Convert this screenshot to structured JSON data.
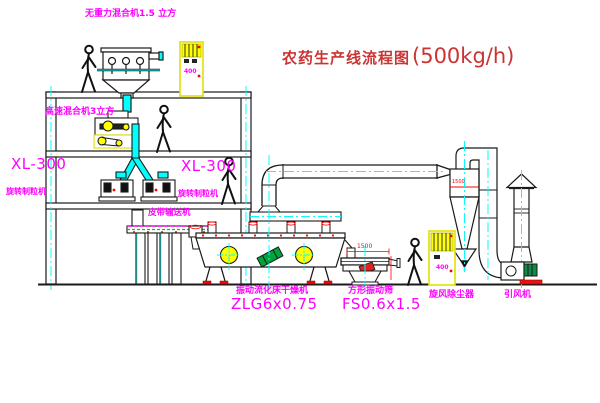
{
  "title": {
    "text": "农药生产线流程图",
    "capacity": "(500kg/h)"
  },
  "equipment": {
    "gravity_mixer": {
      "label": "无重力混合机1.5 立方"
    },
    "speed_mixer": {
      "label": "高速混合机3立方"
    },
    "granulator_left": {
      "model": "XL-300",
      "name": "旋转制粒机"
    },
    "granulator_mid": {
      "model": "XL-300",
      "name": "旋转制粒机"
    },
    "belt_conveyor": {
      "name": "皮带输送机"
    },
    "dryer": {
      "name": "振动流化床干燥机",
      "model": "ZLG6x0.75"
    },
    "screen": {
      "name": "方形振动筛",
      "model": "FS0.6x1.5"
    },
    "cyclone": {
      "name": "旋风除尘器",
      "dim": "1500"
    },
    "fan": {
      "name": "引风机"
    },
    "cabinet_top": {
      "text": "400"
    },
    "cabinet_right": {
      "text": "400"
    }
  },
  "dimensions": {
    "screen_width": "1500"
  },
  "colors": {
    "label_magenta": "#ff00ff",
    "title_red": "#cc3333",
    "cad_red": "#ff0000",
    "centerline_cyan": "#00ffff",
    "cabinet_yellow": "#ffff00",
    "motor_green": "#00a33c",
    "line_black": "#1a1a1a"
  }
}
